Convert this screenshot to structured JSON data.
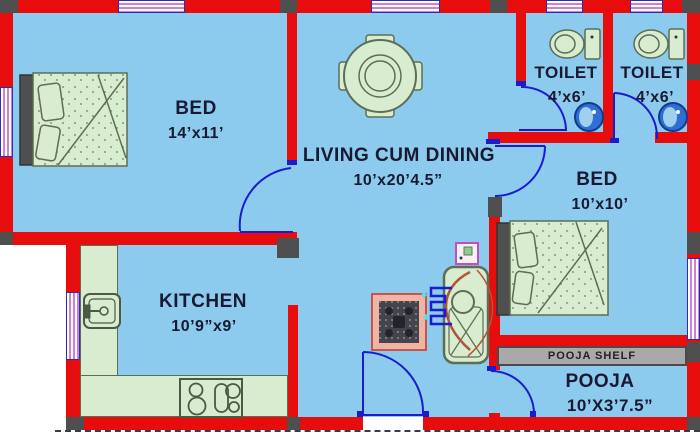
{
  "rooms": {
    "bed1": {
      "label": "BED",
      "dims": "14’x11’"
    },
    "living": {
      "label": "LIVING CUM DINING",
      "dims": "10’x20’4.5”"
    },
    "toilet1": {
      "label": "TOILET",
      "dims": "4’x6’"
    },
    "toilet2": {
      "label": "TOILET",
      "dims": "4’x6’"
    },
    "bed2": {
      "label": "BED",
      "dims": "10’x10’"
    },
    "kitchen": {
      "label": "KITCHEN",
      "dims": "10’9”x9’"
    },
    "pooja": {
      "label": "POOJA",
      "dims": "10’X3’7.5”"
    }
  },
  "shelf": {
    "label": "POOJA SHELF"
  },
  "fixtures": {
    "list": [
      "double-bed-left",
      "double-bed-right",
      "dining-table-4-chairs",
      "kitchen-sink",
      "stove-4-burner",
      "wc-toilet-1",
      "wc-toilet-2",
      "wash-basin-toilet-1",
      "wash-basin-toilet-2",
      "rug",
      "wash-area",
      "wall-switch"
    ]
  },
  "colors": {
    "floor": "#8ccbed",
    "wall": "#e80d0d",
    "corner_block": "#4f4f4f",
    "furniture": "#d8ecd0",
    "furniture_outline": "#5c6e54",
    "door": "#1b1bd0",
    "window_stripe": "#cf7fd8",
    "basin": "#2e6fd6",
    "shelf_bar": "#a9a9a9",
    "text": "#191933"
  }
}
